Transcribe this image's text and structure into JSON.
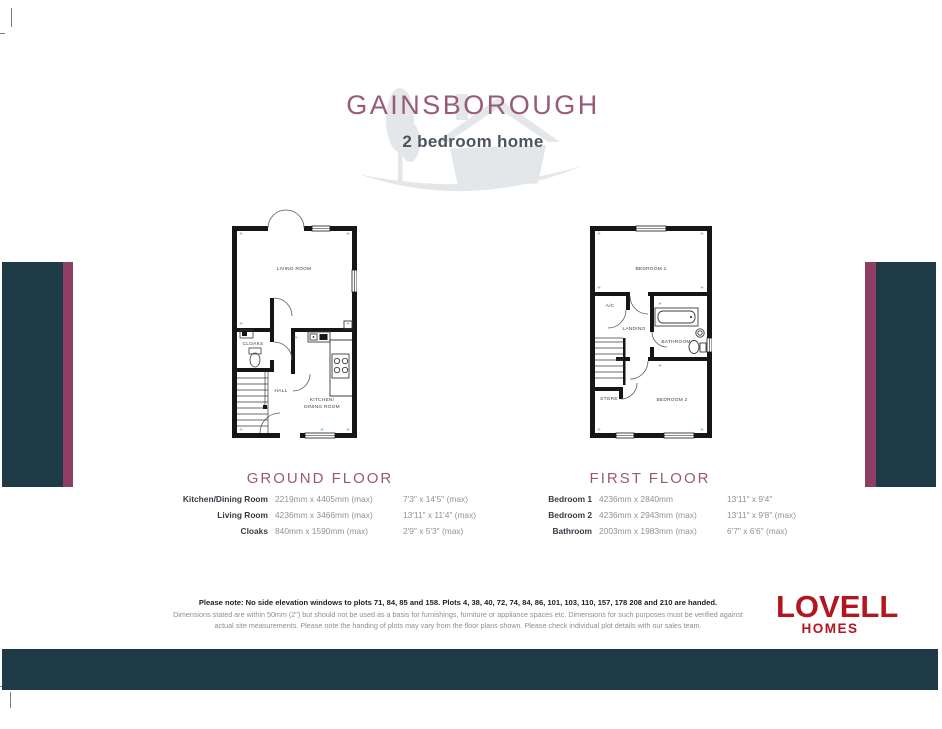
{
  "header": {
    "title": "GAINSBOROUGH",
    "subtitle": "2 bedroom home"
  },
  "ground_floor": {
    "heading": "GROUND FLOOR",
    "rooms": {
      "living_room": "LIVING ROOM",
      "cloaks": "CLOAKS",
      "hall": "HALL",
      "kitchen_line1": "KITCHEN/",
      "kitchen_line2": "DINING ROOM"
    },
    "dimensions": [
      {
        "name": "Kitchen/Dining Room",
        "metric": "2219mm x 4405mm (max)",
        "imperial": "7'3\" x 14'5\" (max)"
      },
      {
        "name": "Living Room",
        "metric": "4236mm x 3466mm (max)",
        "imperial": "13'11\" x 11'4\" (max)"
      },
      {
        "name": "Cloaks",
        "metric": "840mm x 1590mm (max)",
        "imperial": "2'9\" x 5'3\" (max)"
      }
    ]
  },
  "first_floor": {
    "heading": "FIRST FLOOR",
    "rooms": {
      "bedroom1": "BEDROOM 1",
      "ac": "A/C",
      "landing": "LANDING",
      "bathroom": "BATHROOM",
      "store": "STORE",
      "bedroom2": "BEDROOM 2"
    },
    "dimensions": [
      {
        "name": "Bedroom 1",
        "metric": "4236mm x 2840mm",
        "imperial": "13'11\" x 9'4\""
      },
      {
        "name": "Bedroom 2",
        "metric": "4236mm x 2943mm (max)",
        "imperial": "13'11\" x 9'8\" (max)"
      },
      {
        "name": "Bathroom",
        "metric": "2003mm x 1983mm (max)",
        "imperial": "6'7\" x 6'6\" (max)"
      }
    ]
  },
  "footer": {
    "note_bold": "Please note: No side elevation windows to plots 71, 84, 85 and 158. Plots 4, 38, 40, 72, 74, 84, 86, 101, 103, 110, 157, 178 208 and 210 are handed.",
    "note_regular": "Dimensions stated are within 50mm (2\") but should not be used as a basis for furnishings, furniture or appliance spaces etc. Dimensions for such purposes must be verified against actual site measurements. Please note the handing of plots may vary from the floor plans shown. Please check individual plot details with our sales team.",
    "logo_line1": "LOVELL",
    "logo_line2": "HOMES"
  },
  "colors": {
    "teal": "#1e3a46",
    "purple_stripe": "#8e3e63",
    "plum_heading": "#9a5a77",
    "logo_red": "#b4161f",
    "silhouette_gray": "#e4e7e9"
  }
}
